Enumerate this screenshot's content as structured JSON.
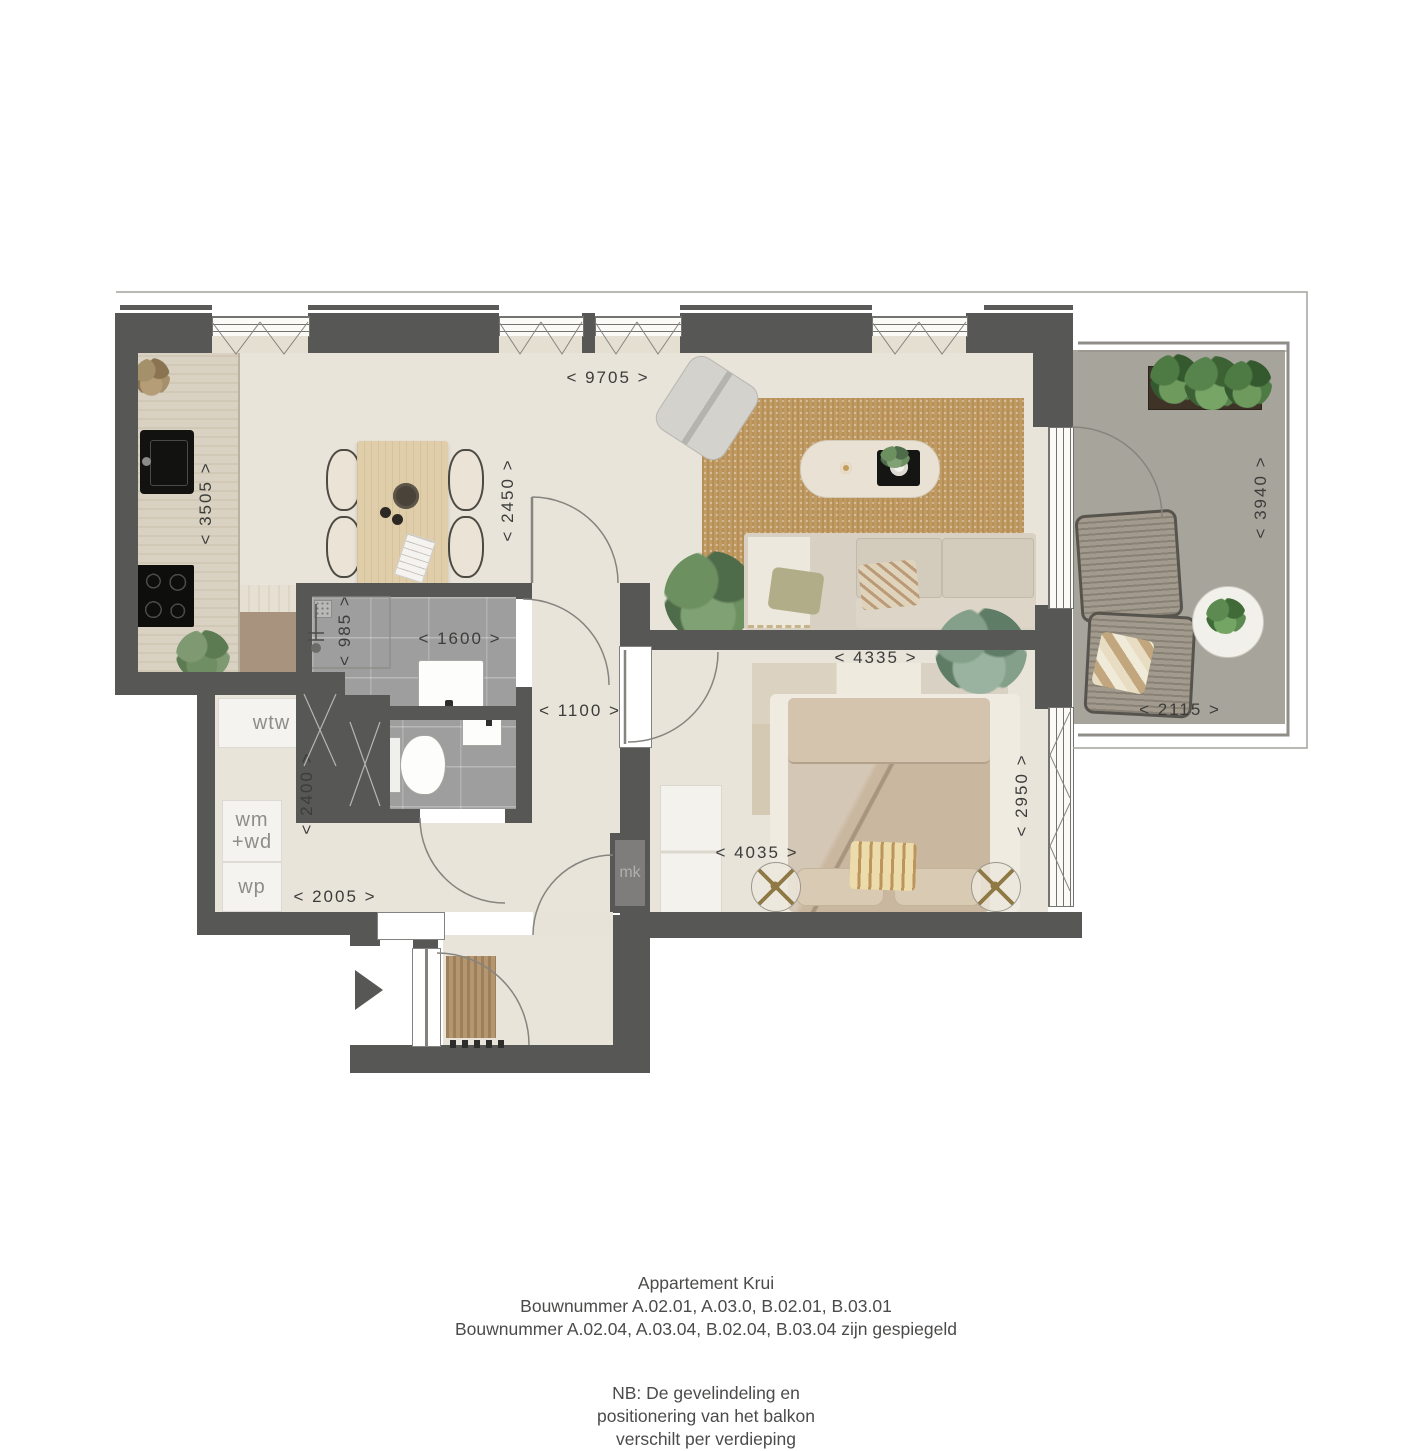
{
  "plan_title": "Appartement Krui floor plan",
  "dimensions": {
    "living_width": "< 9705 >",
    "kitchen_depth": "< 3505 >",
    "living_zone": "< 2450 >",
    "shower_width": "< 985 >",
    "bathroom_width": "< 1600 >",
    "hall_width": "< 1100 >",
    "bedroom_width": "< 4335 >",
    "utility_depth": "< 2400 >",
    "utility_width": "< 2005 >",
    "bedroom_length": "< 4035 >",
    "bedroom_depth": "< 2950 >",
    "balcony_depth": "< 3940 >",
    "balcony_width": "< 2115 >"
  },
  "labels": {
    "heat_recovery_unit": "wtw",
    "washer_line1": "wm",
    "washer_line2": "+wd",
    "heat_pump": "wp",
    "meter_cupboard": "mk"
  },
  "notes": {
    "title": "Appartement Krui",
    "bouwnummers": "Bouwnummer A.02.01, A.03.0, B.02.01, B.03.01",
    "mirrored": "Bouwnummer A.02.04, A.03.04, B.02.04, B.03.04 zijn gespiegeld",
    "nb_line1": "NB: De gevelindeling en",
    "nb_line2": "positionering van het balkon",
    "nb_line3": "verschilt per verdieping"
  },
  "colors": {
    "wall": "#575756",
    "floor": "#e9e4da",
    "bathroom_tile": "#9d9e9d",
    "balcony_floor": "#a7a49b",
    "living_rug": "#c19a62",
    "wood": "#e0cda9"
  }
}
